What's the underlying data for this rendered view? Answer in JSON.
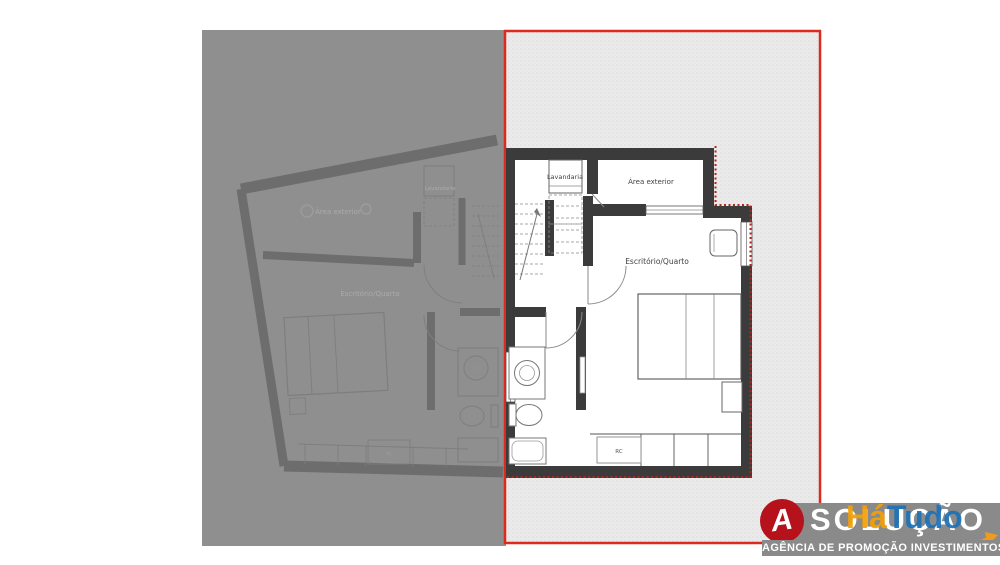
{
  "canvas": {
    "width": 1000,
    "height": 565,
    "background": "#ffffff"
  },
  "colors": {
    "overlay_grey": "#8f8f8f",
    "selection_border": "#dd2a1e",
    "selection_fill": "#ebebeb",
    "wall_dark": "#3b3b3b",
    "boundary_dots": "#b3241c",
    "ghost_wall": "#6a6a6a",
    "ghost_text": "#aeaeae"
  },
  "active_plan": {
    "room_labels": {
      "laundry": "Lavandaria",
      "exterior": "Área exterior",
      "office_bedroom": "Escritório/Quarto",
      "closet": "RC"
    }
  },
  "ghost_plan": {
    "room_labels": {
      "laundry": "Lavandaria",
      "exterior": "Área exterior",
      "office_bedroom": "Escritório/Quarto",
      "closet": "RC"
    }
  },
  "logo": {
    "monogram": "A",
    "brand_word": "SOLUÇÃO",
    "overlay_word_1": "Há",
    "overlay_word_2": "Tudo",
    "tagline": "AGÊNCIA DE PROMOÇÃO INVESTIMENTOS",
    "colors": {
      "badge": "#b5121b",
      "band": "#8a8a8a",
      "accent_orange": "#f2a007",
      "accent_blue": "#1d72b8"
    }
  }
}
